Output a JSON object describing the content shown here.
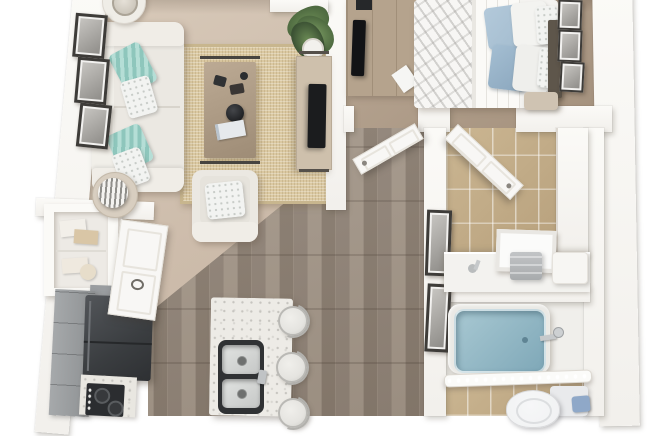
{
  "scene": {
    "type": "3d-floorplan-top-view",
    "subject": "one-bedroom apartment 3D floor plan render",
    "rooms": [
      {
        "name": "living-room",
        "floor": "beige-carpet",
        "items": [
          "white-sofa",
          "teal-striped-pillows",
          "white-patterned-pillows",
          "round-side-table-with-lamp",
          "round-side-table-with-sphere-lamp",
          "jute-area-rug",
          "wood-coffee-table",
          "decor-bowl",
          "decor-book",
          "white-armchair",
          "potted-plant",
          "media-console",
          "flat-screen-tv",
          "gallery-wall-three-frames"
        ]
      },
      {
        "name": "bedroom",
        "floor": "tan-carpet",
        "items": [
          "bed-with-floral-duvet",
          "blue-accent-pillows",
          "white-pillows",
          "dark-headboard",
          "wall-art-three-frames",
          "dresser",
          "flat-screen-tv",
          "bed-bench"
        ]
      },
      {
        "name": "kitchen",
        "floor": "wood-plank",
        "items": [
          "gray-base-cabinets",
          "upper-cabinet",
          "dark-refrigerator",
          "cooktop-range",
          "speckled-counter",
          "entry-door-open",
          "storage-nook-shelves",
          "kitchen-island",
          "double-basin-sink",
          "island-faucet",
          "bar-stool",
          "bar-stool",
          "bar-stool"
        ]
      },
      {
        "name": "hallway",
        "floor": "wood-plank",
        "items": [
          "bedroom-door-open",
          "bathroom-door-open",
          "wall-art-two-frames"
        ]
      },
      {
        "name": "bathroom",
        "floor": "beige-tile",
        "items": [
          "vanity-counter",
          "vanity-sink-faucet",
          "leaning-mirror-panel",
          "towel-stack",
          "storage-box",
          "linen-closet",
          "blue-bathtub",
          "tub-faucet",
          "shower-rod-with-lights",
          "toilet",
          "toilet-tank",
          "blue-accessory"
        ]
      }
    ],
    "palette": {
      "bg": "#ffffff",
      "wall": "#f2f0ec",
      "wall-bright": "#fbfaf7",
      "wall-edge": "#ddd8d1",
      "carpet-light": "#d9cbbb",
      "carpet-mid": "#cdbcab",
      "carpet-dark": "#bfae9c",
      "bedroom-carpet-light": "#b9a794",
      "bedroom-carpet-dark": "#a3907c",
      "wood-a": "#9c8f82",
      "wood-b": "#93867a",
      "wood-c": "#a79a8c",
      "wood-d": "#8b7e71",
      "tile-light": "#cbb692",
      "tile-dark": "#b7a07c",
      "rug": "#dbc9a2",
      "rug-edge": "#c8b68e",
      "sofa-white": "#ebe8e2",
      "teal-a": "#8ec6bc",
      "teal-b": "#b5ded6",
      "table-wood": "#b3a08a",
      "black": "#1b1c1e",
      "console-wood": "#cec0ac",
      "plant-green": "#6d8d56",
      "plant-dark": "#4e6a40",
      "island-white": "#edebe6",
      "sink-dark": "#303234",
      "sink-steel": "#d4d6d4",
      "stool-white": "#e5e4e0",
      "cabinet-gray": "#9da0a2",
      "appliance-dark": "#3a3d40",
      "counter-speckle": "#e9e7e1",
      "bed-white": "#f4f3f0",
      "pillow-blue": "#a3bccf",
      "headboard-brown": "#5e564b",
      "dresser-wood": "#b5a38d",
      "frame-dark": "#3e3c39",
      "frame-mat": "#f2f1ef",
      "tub-blue-light": "#a8c8d2",
      "tub-blue": "#7fa8b8",
      "porcelain": "#f0f1f2",
      "door-white": "#f8f7f5",
      "towel-gray": "#b4b6b8",
      "accessory-blue": "#8fa8c8"
    }
  }
}
